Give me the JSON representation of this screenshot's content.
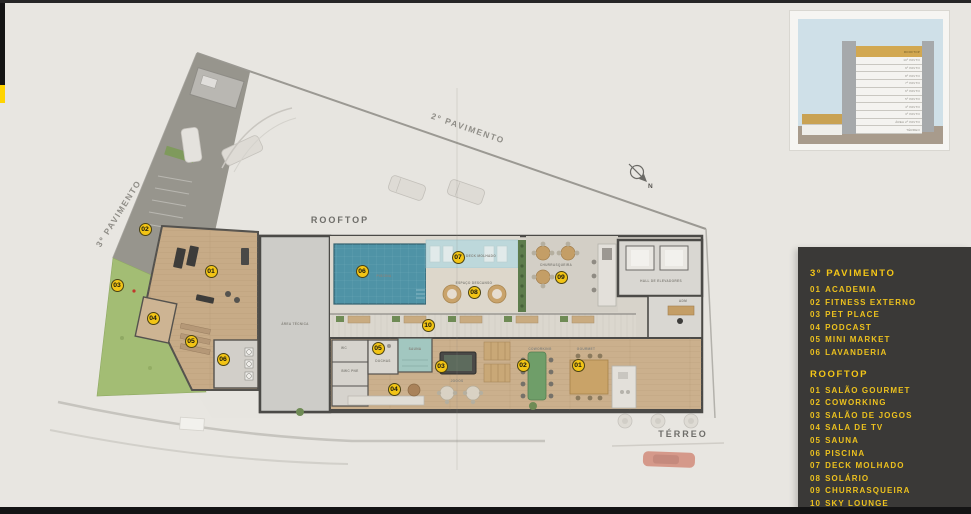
{
  "page": {
    "background": "#e8e6e1",
    "accent_yellow": "#f2c415",
    "bars": {
      "top": "#262626",
      "left_black": "#141414",
      "left_yellow": "#ffd400",
      "bottom": "#141414"
    }
  },
  "inset": {
    "floors": [
      "ROOFTOP",
      "10º PAVTO",
      "9º PAVTO",
      "8º PAVTO",
      "7º PAVTO",
      "6º PAVTO",
      "5º PAVTO",
      "4º PAVTO",
      "3º PAVTO",
      "ÁREA 2º PAVTO",
      "TÉRREO"
    ],
    "colors": {
      "sky": "#cfe0e8",
      "ground": "#a89b8c",
      "tower": "#a6a9ab",
      "rooftop_band": "#d2a851",
      "floor": "#f4f3f0"
    }
  },
  "legend": {
    "bg": "#3a3937",
    "text_color": "#f4c617",
    "sections": [
      {
        "title": "3º PAVIMENTO",
        "items": [
          {
            "num": "01",
            "label": "ACADEMIA"
          },
          {
            "num": "02",
            "label": "FITNESS EXTERNO"
          },
          {
            "num": "03",
            "label": "PET PLACE"
          },
          {
            "num": "04",
            "label": "PODCAST"
          },
          {
            "num": "05",
            "label": "MINI MARKET"
          },
          {
            "num": "06",
            "label": "LAVANDERIA"
          }
        ]
      },
      {
        "title": "ROOFTOP",
        "items": [
          {
            "num": "01",
            "label": "SALÃO GOURMET"
          },
          {
            "num": "02",
            "label": "COWORKING"
          },
          {
            "num": "03",
            "label": "SALÃO DE JOGOS"
          },
          {
            "num": "04",
            "label": "SALA DE TV"
          },
          {
            "num": "05",
            "label": "SAUNA"
          },
          {
            "num": "06",
            "label": "PISCINA"
          },
          {
            "num": "07",
            "label": "DECK MOLHADO"
          },
          {
            "num": "08",
            "label": "SOLÁRIO"
          },
          {
            "num": "09",
            "label": "CHURRASQUEIRA"
          },
          {
            "num": "10",
            "label": "SKY LOUNGE"
          }
        ]
      }
    ]
  },
  "plan": {
    "labels": {
      "pav2": "2º PAVIMENTO",
      "pav3": "3º PAVIMENTO",
      "rooftop": "ROOFTOP",
      "terreo": "TÉRREO",
      "piscina": "PISCINA",
      "area_tecnica": "ÁREA TÉCNICA",
      "churrasqueira": "CHURRASQUEIRA",
      "hall_elevadores": "HALL DE ELEVADORES",
      "adm": "ADM",
      "sauna": "SAUNA",
      "duchas": "DUCHAS",
      "wc": "WC",
      "bwc_pne": "BWC PNE",
      "jogos": "JOGOS",
      "coworking": "COWORKING",
      "gourmet": "GOURMET",
      "deck_molhado": "DECK MOLHADO",
      "espaco_descanso": "ESPAÇO DESCANSO",
      "north": "N"
    },
    "badge_style": {
      "bg": "#f2c415",
      "text": "#151510"
    },
    "badges": [
      {
        "group": "3-pavimento",
        "num": "01",
        "x": 211,
        "y": 271
      },
      {
        "group": "3-pavimento",
        "num": "02",
        "x": 145,
        "y": 229
      },
      {
        "group": "3-pavimento",
        "num": "03",
        "x": 117,
        "y": 285
      },
      {
        "group": "3-pavimento",
        "num": "04",
        "x": 153,
        "y": 318
      },
      {
        "group": "3-pavimento",
        "num": "05",
        "x": 191,
        "y": 341
      },
      {
        "group": "3-pavimento",
        "num": "06",
        "x": 223,
        "y": 359
      },
      {
        "group": "rooftop",
        "num": "01",
        "x": 578,
        "y": 365
      },
      {
        "group": "rooftop",
        "num": "02",
        "x": 523,
        "y": 365
      },
      {
        "group": "rooftop",
        "num": "03",
        "x": 441,
        "y": 366
      },
      {
        "group": "rooftop",
        "num": "04",
        "x": 394,
        "y": 389
      },
      {
        "group": "rooftop",
        "num": "05",
        "x": 378,
        "y": 348
      },
      {
        "group": "rooftop",
        "num": "06",
        "x": 362,
        "y": 271
      },
      {
        "group": "rooftop",
        "num": "07",
        "x": 458,
        "y": 257
      },
      {
        "group": "rooftop",
        "num": "08",
        "x": 474,
        "y": 292
      },
      {
        "group": "rooftop",
        "num": "09",
        "x": 561,
        "y": 277
      },
      {
        "group": "rooftop",
        "num": "10",
        "x": 428,
        "y": 325
      }
    ]
  }
}
